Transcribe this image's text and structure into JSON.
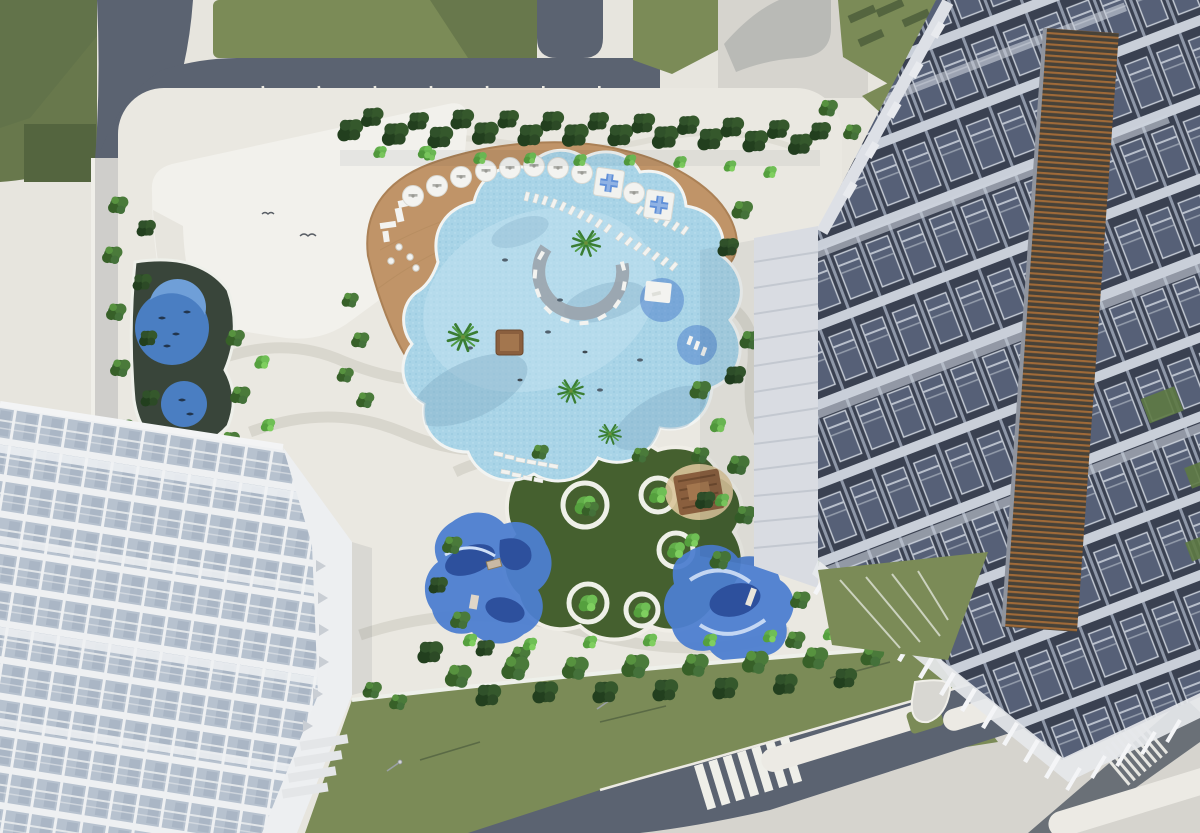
{
  "scene": {
    "title": "Aerial 3D rendering of a residential complex courtyard with free-form lagoon pool",
    "view": "top-down aerial architectural visualization",
    "areas": {
      "streets": {
        "label": "perimeter streets with lawns, sidewalks and crosswalks"
      },
      "podium_roof": {
        "label": "white podium roof with drop-off driveway"
      },
      "splash_pads": {
        "label": "children splash pads with fish decals",
        "count": 2
      },
      "pool": {
        "label": "free-form lagoon swimming pool"
      },
      "sun_deck": {
        "label": "timber sun deck with umbrellas and loungers"
      },
      "sun_shelf": {
        "label": "in-pool circular sun shelf with radial loungers"
      },
      "kids_garden": {
        "label": "organic play lawn with circular tree planters",
        "planter_count": 5
      },
      "playgrounds": {
        "label": "blue rubber playground surfaces",
        "count": 2
      },
      "pergola": {
        "label": "timber pergola seating nook"
      },
      "left_tower": {
        "label": "white residential tower with glass balconies"
      },
      "right_tower": {
        "label": "residential tower with dark glazing and timber louvers"
      },
      "south_lawn": {
        "label": "south lawn strip with lamp posts"
      },
      "south_road": {
        "label": "south road with zebra crossing and white medians"
      }
    },
    "features": {
      "umbrellas": 9,
      "cabana_platforms": 2,
      "pool_pavilion": 1,
      "palm_trees": 4,
      "tree_planter_rings": 5,
      "zebra_crossings": 2,
      "lamp_posts": 4
    }
  },
  "palette": {
    "pavement": "#e7e5de",
    "pavement2": "#d6d4ce",
    "road": "#5b6371",
    "roadLight": "#6a7077",
    "sidewalk": "#cfcecb",
    "lawn": "#7b8b57",
    "lawnDark": "#68784c",
    "hedge": "#54653f",
    "courtyard": "#eae8e1",
    "white": "#f2f1ec",
    "deck": "#c09468",
    "deckDark": "#a87f56",
    "pool": "#a9d4e7",
    "poolDeep": "#7fa9c2",
    "poolLight": "#c6e4f1",
    "kidsLawn": "#45602f",
    "playBlue": "#4d7ed0",
    "playNavy": "#2d509d",
    "splashDark": "#39453a",
    "splashBlue": "#4a7ec2",
    "bldgDark": "#3a4151",
    "slab": "#c9cfd9",
    "mullion": "#8e97a8",
    "glass": "#566077",
    "louverWood": "#a06a38",
    "louverDark": "#474239",
    "whiteBldg": "#eef0f2",
    "whiteGlass": "#b7c2cf",
    "whiteWall": "#d9dce2",
    "roofBand": "#edeff1",
    "treeDark": "#2c4a26",
    "treeMid": "#3f6b33",
    "treeLight": "#62ad4a",
    "palmGreen": "#3a7d33",
    "furniture": "#f3f3f0",
    "crossBlue": "#5f8fd8",
    "woodBrown": "#8a5f3e"
  }
}
